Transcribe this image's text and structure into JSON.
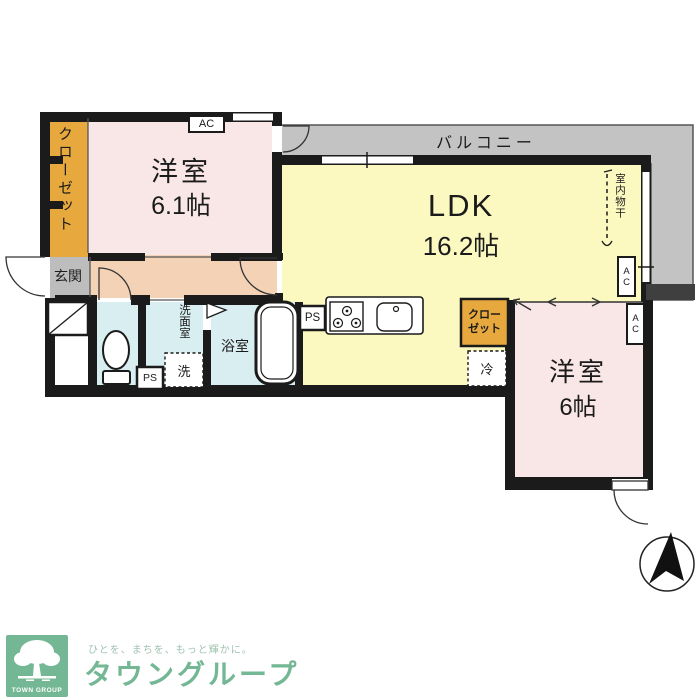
{
  "floorplan": {
    "rooms": {
      "bedroom1": {
        "name": "洋室",
        "size": "6.1帖"
      },
      "ldk": {
        "name": "LDK",
        "size": "16.2帖"
      },
      "bedroom2": {
        "name": "洋室",
        "size": "6帖"
      },
      "balcony": "バルコニー",
      "entrance": "玄関",
      "bathroom": "浴室",
      "washroom": "洗面室",
      "closet_main": "クローゼット",
      "closet_bedroom2_line1": "クロー",
      "closet_bedroom2_line2": "ゼット",
      "indoor_drying": "室内物干"
    },
    "equipment": {
      "ac": "AC",
      "ps": "PS",
      "washer": "洗",
      "fridge": "冷"
    }
  },
  "footer": {
    "logo_caption": "TOWN GROUP",
    "tagline": "ひとを、まちを、もっと輝かに。",
    "company": "タウングループ"
  },
  "colors": {
    "bedroom_pink": "#f8e7e6",
    "ldk_yellow": "#fbf8c0",
    "balcony_gray": "#c3c3c3",
    "hall_peach": "#f3d2b6",
    "wet_blue": "#d8eef1",
    "closet_orange": "#e7a93e",
    "entrance_gray": "#bdbdbd",
    "wall_black": "#1b1b1b",
    "brand_green": "#74b794"
  }
}
